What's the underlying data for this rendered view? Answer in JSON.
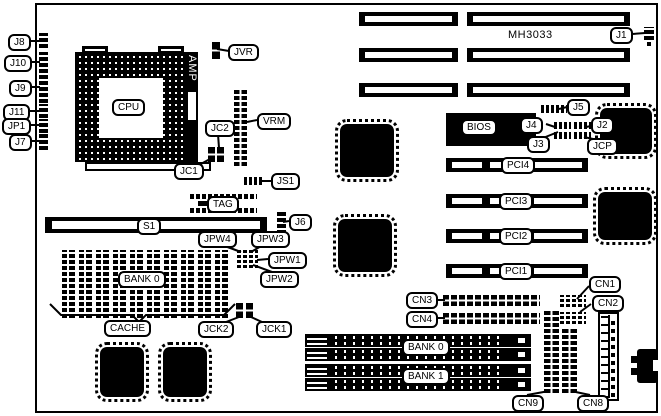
{
  "board": {
    "model": "MH3033",
    "amp_label": "AMP"
  },
  "callouts": [
    {
      "id": "j8",
      "text": "J8",
      "x": 8,
      "y": 34
    },
    {
      "id": "j10",
      "text": "J10",
      "x": 4,
      "y": 55
    },
    {
      "id": "j9",
      "text": "J9",
      "x": 9,
      "y": 80
    },
    {
      "id": "j11",
      "text": "J11",
      "x": 3,
      "y": 104
    },
    {
      "id": "jp1",
      "text": "JP1",
      "x": 2,
      "y": 118
    },
    {
      "id": "j7",
      "text": "J7",
      "x": 9,
      "y": 134
    },
    {
      "id": "jvr",
      "text": "JVR",
      "x": 228,
      "y": 44
    },
    {
      "id": "j1",
      "text": "J1",
      "x": 610,
      "y": 27
    },
    {
      "id": "jc2",
      "text": "JC2",
      "x": 205,
      "y": 120
    },
    {
      "id": "vrm",
      "text": "VRM",
      "x": 257,
      "y": 113
    },
    {
      "id": "jc1",
      "text": "JC1",
      "x": 174,
      "y": 163
    },
    {
      "id": "js1",
      "text": "JS1",
      "x": 271,
      "y": 173
    },
    {
      "id": "tag",
      "text": "TAG",
      "x": 207,
      "y": 196
    },
    {
      "id": "s1",
      "text": "S1",
      "x": 137,
      "y": 218
    },
    {
      "id": "j6",
      "text": "J6",
      "x": 289,
      "y": 214
    },
    {
      "id": "jpw4",
      "text": "JPW4",
      "x": 198,
      "y": 231
    },
    {
      "id": "jpw3",
      "text": "JPW3",
      "x": 251,
      "y": 231
    },
    {
      "id": "jpw1",
      "text": "JPW1",
      "x": 268,
      "y": 252
    },
    {
      "id": "jpw2",
      "text": "JPW2",
      "x": 260,
      "y": 271
    },
    {
      "id": "cpu",
      "text": "CPU",
      "x": 112,
      "y": 99
    },
    {
      "id": "bank0-dram",
      "text": "BANK 0",
      "x": 118,
      "y": 271
    },
    {
      "id": "cache",
      "text": "CACHE",
      "x": 104,
      "y": 320
    },
    {
      "id": "jck2",
      "text": "JCK2",
      "x": 198,
      "y": 321
    },
    {
      "id": "jck1",
      "text": "JCK1",
      "x": 256,
      "y": 321
    },
    {
      "id": "bios",
      "text": "BIOS",
      "x": 461,
      "y": 119
    },
    {
      "id": "j5",
      "text": "J5",
      "x": 567,
      "y": 99
    },
    {
      "id": "j4",
      "text": "J4",
      "x": 520,
      "y": 117
    },
    {
      "id": "j2",
      "text": "J2",
      "x": 591,
      "y": 117
    },
    {
      "id": "j3",
      "text": "J3",
      "x": 527,
      "y": 136
    },
    {
      "id": "jcp",
      "text": "JCP",
      "x": 587,
      "y": 138
    },
    {
      "id": "pci4",
      "text": "PCI4",
      "x": 501,
      "y": 157
    },
    {
      "id": "pci3",
      "text": "PCI3",
      "x": 499,
      "y": 193
    },
    {
      "id": "pci2",
      "text": "PCI2",
      "x": 499,
      "y": 228
    },
    {
      "id": "pci1",
      "text": "PCI1",
      "x": 499,
      "y": 263
    },
    {
      "id": "cn3",
      "text": "CN3",
      "x": 406,
      "y": 292
    },
    {
      "id": "cn4",
      "text": "CN4",
      "x": 406,
      "y": 311
    },
    {
      "id": "cn1",
      "text": "CN1",
      "x": 589,
      "y": 276
    },
    {
      "id": "cn2",
      "text": "CN2",
      "x": 592,
      "y": 295
    },
    {
      "id": "bank0-simm",
      "text": "BANK 0",
      "x": 402,
      "y": 339
    },
    {
      "id": "bank1",
      "text": "BANK 1",
      "x": 402,
      "y": 368
    },
    {
      "id": "cn9",
      "text": "CN9",
      "x": 512,
      "y": 395
    },
    {
      "id": "cn8",
      "text": "CN8",
      "x": 577,
      "y": 395
    }
  ],
  "leaders": [
    [
      [
        28,
        41
      ],
      [
        40,
        41
      ]
    ],
    [
      [
        29,
        62
      ],
      [
        40,
        62
      ]
    ],
    [
      [
        29,
        87
      ],
      [
        40,
        87
      ]
    ],
    [
      [
        29,
        111
      ],
      [
        40,
        111
      ]
    ],
    [
      [
        27,
        125
      ],
      [
        40,
        125
      ]
    ],
    [
      [
        31,
        141
      ],
      [
        40,
        141
      ]
    ],
    [
      [
        229,
        51
      ],
      [
        217,
        49
      ]
    ],
    [
      [
        632,
        34
      ],
      [
        645,
        33
      ]
    ],
    [
      [
        218,
        134
      ],
      [
        219,
        148
      ]
    ],
    [
      [
        199,
        165
      ],
      [
        210,
        159
      ]
    ],
    [
      [
        257,
        120
      ],
      [
        247,
        122
      ]
    ],
    [
      [
        271,
        181
      ],
      [
        262,
        181
      ]
    ],
    [
      [
        289,
        221
      ],
      [
        283,
        222
      ]
    ],
    [
      [
        222,
        245
      ],
      [
        241,
        252
      ]
    ],
    [
      [
        263,
        245
      ],
      [
        251,
        252
      ]
    ],
    [
      [
        268,
        259
      ],
      [
        257,
        260
      ]
    ],
    [
      [
        272,
        272
      ],
      [
        253,
        265
      ]
    ],
    [
      [
        226,
        322
      ],
      [
        239,
        317
      ]
    ],
    [
      [
        262,
        322
      ],
      [
        251,
        317
      ]
    ],
    [
      [
        567,
        107
      ],
      [
        559,
        109
      ]
    ],
    [
      [
        546,
        124
      ],
      [
        555,
        127
      ]
    ],
    [
      [
        591,
        126
      ],
      [
        586,
        127
      ]
    ],
    [
      [
        543,
        138
      ],
      [
        558,
        132
      ]
    ],
    [
      [
        593,
        139
      ],
      [
        584,
        137
      ]
    ],
    [
      [
        433,
        300
      ],
      [
        445,
        300
      ]
    ],
    [
      [
        433,
        318
      ],
      [
        445,
        318
      ]
    ],
    [
      [
        589,
        286
      ],
      [
        577,
        299
      ]
    ],
    [
      [
        591,
        304
      ],
      [
        580,
        312
      ]
    ],
    [
      [
        527,
        395
      ],
      [
        549,
        391
      ]
    ],
    [
      [
        590,
        395
      ],
      [
        571,
        391
      ]
    ],
    [
      [
        50,
        304
      ],
      [
        61,
        315
      ],
      [
        132,
        315
      ],
      [
        139,
        322
      ],
      [
        146,
        315
      ],
      [
        224,
        315
      ],
      [
        235,
        304
      ]
    ]
  ]
}
